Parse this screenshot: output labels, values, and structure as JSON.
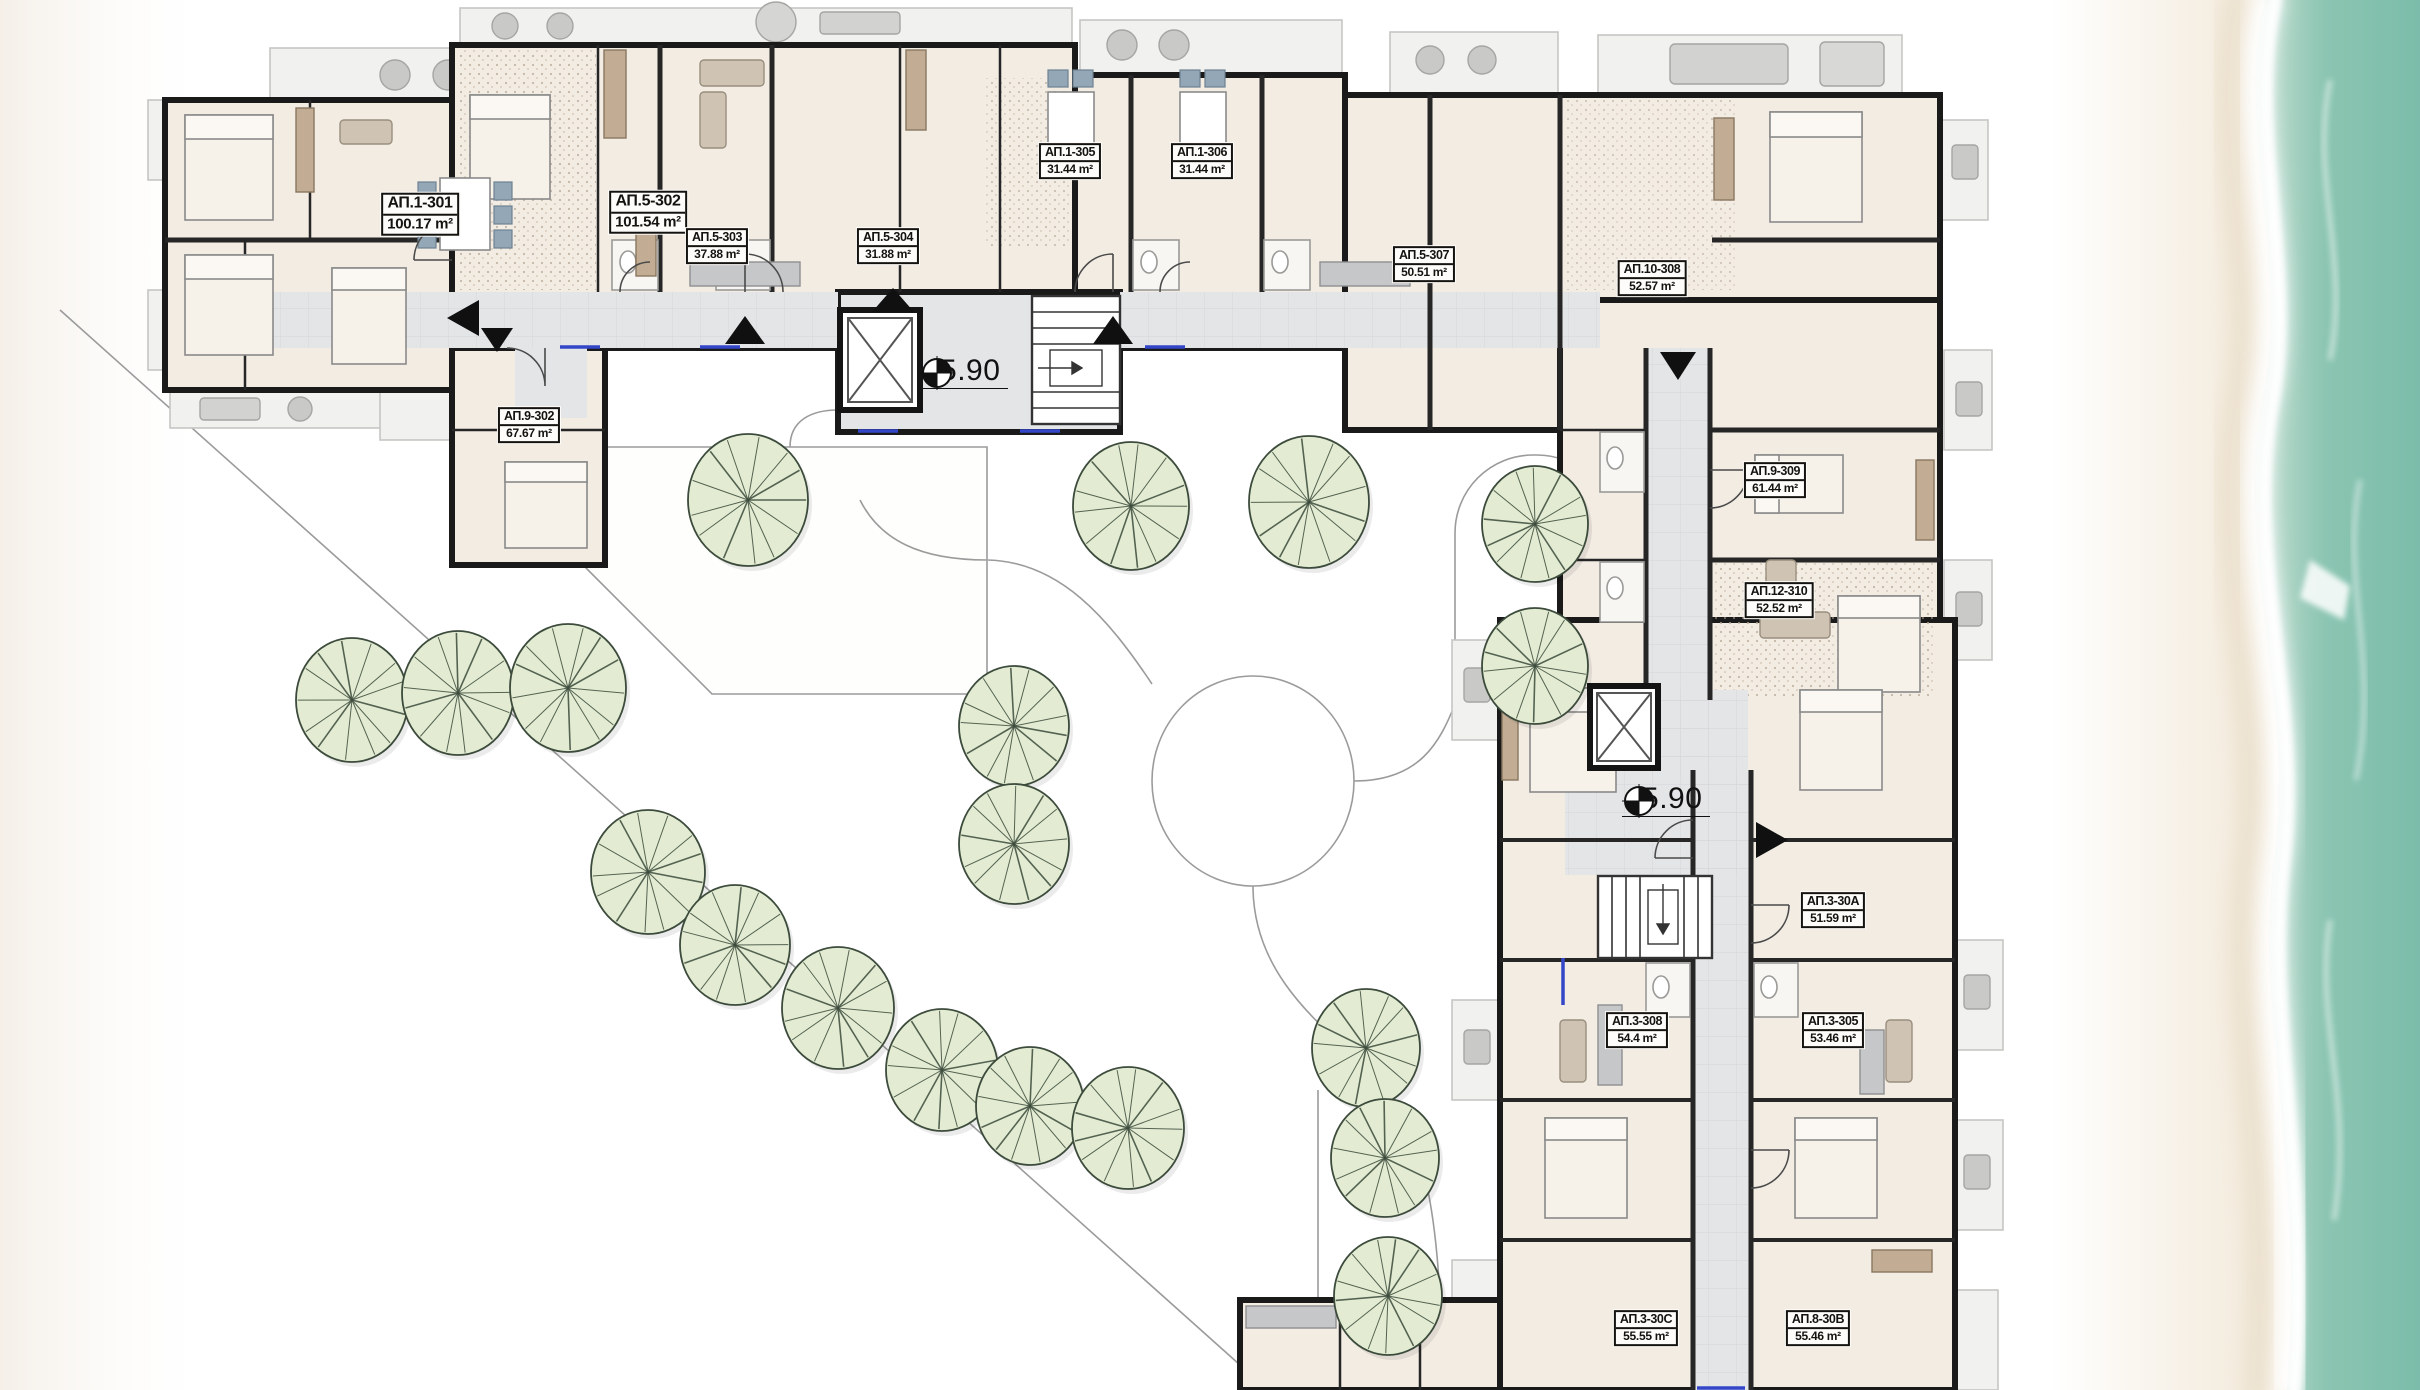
{
  "plan": {
    "type": "architectural-site-floor-plan",
    "level": "+5.90",
    "area_unit": "m²"
  },
  "level_markers": [
    {
      "text": "+5.90",
      "x": 920,
      "y": 372
    },
    {
      "text": "+5.90",
      "x": 1622,
      "y": 800
    }
  ],
  "apartment_labels": [
    {
      "name": "АП.1-301",
      "area": "100.17 m²",
      "x": 420,
      "y": 214,
      "size": "lg"
    },
    {
      "name": "АП.5-302",
      "area": "101.54 m²",
      "x": 648,
      "y": 212,
      "size": "lg"
    },
    {
      "name": "АП.5-303",
      "area": "37.88 m²",
      "x": 717,
      "y": 246,
      "size": "sm"
    },
    {
      "name": "АП.5-304",
      "area": "31.88 m²",
      "x": 888,
      "y": 246,
      "size": "sm"
    },
    {
      "name": "АП.1-305",
      "area": "31.44 m²",
      "x": 1070,
      "y": 161,
      "size": "sm"
    },
    {
      "name": "АП.1-306",
      "area": "31.44 m²",
      "x": 1202,
      "y": 161,
      "size": "sm"
    },
    {
      "name": "АП.5-307",
      "area": "50.51 m²",
      "x": 1424,
      "y": 264,
      "size": "sm"
    },
    {
      "name": "АП.10-308",
      "area": "52.57 m²",
      "x": 1652,
      "y": 278,
      "size": "sm"
    },
    {
      "name": "АП.9-309",
      "area": "61.44 m²",
      "x": 1775,
      "y": 480,
      "size": "sm"
    },
    {
      "name": "АП.12-310",
      "area": "52.52 m²",
      "x": 1779,
      "y": 600,
      "size": "sm"
    },
    {
      "name": "АП.3-30А",
      "area": "51.59 m²",
      "x": 1833,
      "y": 910,
      "size": "sm"
    },
    {
      "name": "АП.3-308",
      "area": "54.4 m²",
      "x": 1637,
      "y": 1030,
      "size": "sm"
    },
    {
      "name": "АП.3-305",
      "area": "53.46 m²",
      "x": 1833,
      "y": 1030,
      "size": "sm"
    },
    {
      "name": "АП.3-30С",
      "area": "55.55 m²",
      "x": 1646,
      "y": 1328,
      "size": "sm"
    },
    {
      "name": "АП.8-30В",
      "area": "55.46 m²",
      "x": 1818,
      "y": 1328,
      "size": "sm"
    },
    {
      "name": "АП.9-302",
      "area": "67.67 m²",
      "x": 529,
      "y": 425,
      "size": "sm"
    }
  ],
  "trees": [
    {
      "x": 748,
      "y": 500,
      "rx": 60,
      "ry": 66
    },
    {
      "x": 1014,
      "y": 726,
      "rx": 55,
      "ry": 60
    },
    {
      "x": 1014,
      "y": 844,
      "rx": 55,
      "ry": 60
    },
    {
      "x": 1131,
      "y": 506,
      "rx": 58,
      "ry": 64
    },
    {
      "x": 1309,
      "y": 502,
      "rx": 60,
      "ry": 66
    },
    {
      "x": 1535,
      "y": 524,
      "rx": 53,
      "ry": 58
    },
    {
      "x": 1535,
      "y": 666,
      "rx": 53,
      "ry": 58
    },
    {
      "x": 352,
      "y": 700,
      "rx": 56,
      "ry": 62
    },
    {
      "x": 458,
      "y": 693,
      "rx": 56,
      "ry": 62
    },
    {
      "x": 568,
      "y": 688,
      "rx": 58,
      "ry": 64
    },
    {
      "x": 648,
      "y": 872,
      "rx": 57,
      "ry": 62
    },
    {
      "x": 735,
      "y": 945,
      "rx": 55,
      "ry": 60
    },
    {
      "x": 838,
      "y": 1008,
      "rx": 56,
      "ry": 61
    },
    {
      "x": 942,
      "y": 1070,
      "rx": 56,
      "ry": 61
    },
    {
      "x": 1030,
      "y": 1106,
      "rx": 54,
      "ry": 59
    },
    {
      "x": 1128,
      "y": 1128,
      "rx": 56,
      "ry": 61
    },
    {
      "x": 1366,
      "y": 1048,
      "rx": 54,
      "ry": 59
    },
    {
      "x": 1385,
      "y": 1158,
      "rx": 54,
      "ry": 59
    },
    {
      "x": 1388,
      "y": 1296,
      "rx": 54,
      "ry": 59
    }
  ],
  "colors": {
    "wall": "#1a1a1a",
    "room_fill": "#f2ece3",
    "carpet_fill": "#ddd2c5",
    "corridor_fill": "#e4e5e7",
    "tree_fill": "#e3ecd2",
    "tree_stroke": "#3c4b3c",
    "sea": "#7fbfae",
    "sand": "#efe5d4",
    "foam": "#ffffff",
    "path_line": "#9b9b9b",
    "chair_blue": "#93a7b6",
    "wood": "#c2ad94",
    "window_blue": "#3346c8"
  }
}
